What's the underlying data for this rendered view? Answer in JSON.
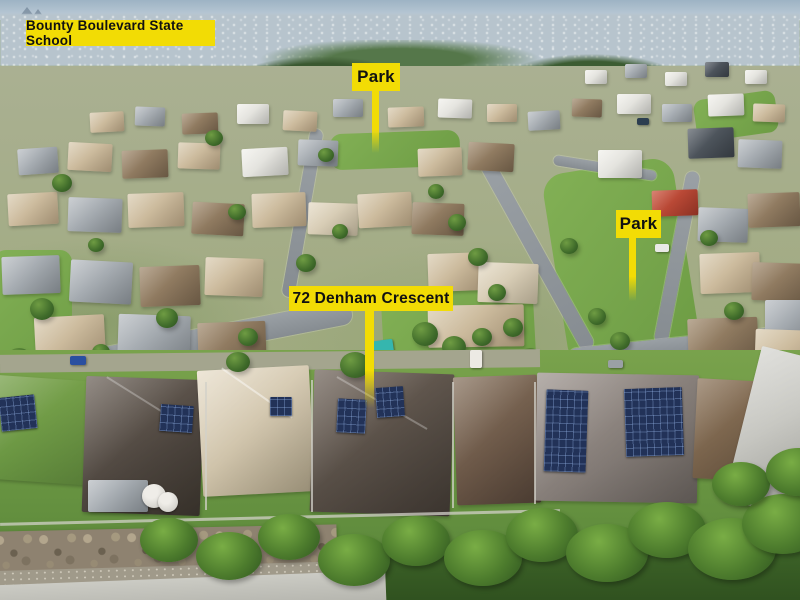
{
  "photo": {
    "annotations": {
      "school": "Bounty Boulevard State School",
      "park_top": "Park",
      "park_right": "Park",
      "property": "72 Denham Crescent"
    },
    "colors": {
      "annotation_bg": "#f2dc05",
      "annotation_text": "#111111",
      "grass": "#6f9e46",
      "road": "#9aa0a5",
      "roof_brown": "#7c6850",
      "solar_panel": "#223258"
    }
  }
}
